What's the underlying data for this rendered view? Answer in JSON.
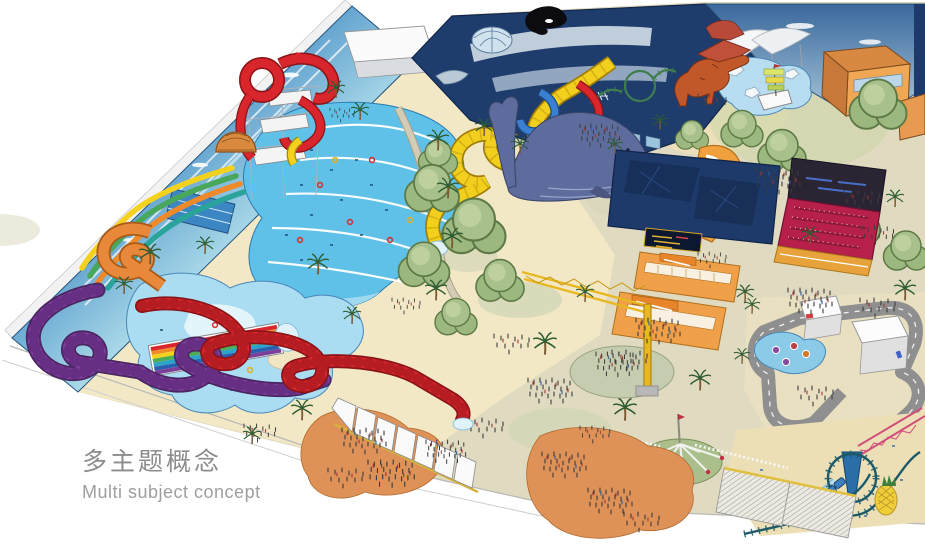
{
  "caption": {
    "title_zh": "多主题概念",
    "subtitle_en": "Multi subject concept",
    "title_color": "#8c8c8c",
    "subtitle_color": "#9e9e9e"
  },
  "illustration": {
    "type": "isometric hand-drawn concept rendering of a multi-themed indoor park",
    "zones": [
      {
        "name": "water-park",
        "features": [
          "ocean-mural-perimeter-wall",
          "wave-pool-with-swimmers",
          "red-slide-tower-complex",
          "yellow-serpentine-slide",
          "blue-tube-slide",
          "red-tube-slide",
          "rainbow-racer-slide",
          "purple-coil-slide",
          "red-coil-slide",
          "orange-spiral-slide",
          "kids-pool",
          "lap-pool",
          "palm-trees",
          "white-roof-box"
        ]
      },
      {
        "name": "aquarium-zone",
        "features": [
          "dark-navy-aquarium-building",
          "orca-mural",
          "glass-dome",
          "fish-murals",
          "whale-statue"
        ]
      },
      {
        "name": "dinosaur-zone",
        "features": [
          "sky-mural-wall",
          "t-rex-statue",
          "roof-dinosaur",
          "rapids-pool-with-ship",
          "ice-rocks",
          "green-mini-coaster",
          "orange-lodge-buildings",
          "white-sail-canopy"
        ]
      },
      {
        "name": "show-zone",
        "features": [
          "navy-show-building",
          "marquee-sign",
          "red-amphitheater-with-screen",
          "orange-retail-stands"
        ]
      },
      {
        "name": "rides-zone",
        "features": [
          "go-kart-track",
          "kart-pit-buildings",
          "bumper-boat-pond",
          "roller-coaster-with-loop",
          "blue-coaster-train",
          "pineapple-sculpture",
          "pink-truss-bridge",
          "star-flyer-ride",
          "yellow-crane-ride"
        ]
      },
      {
        "name": "entrance-promenade",
        "features": [
          "white-canopy-walkway",
          "orange-plazas",
          "crowds",
          "central-tree-cluster",
          "hatched-roofs"
        ]
      }
    ],
    "palette": {
      "wall_blue_deep": "#2a5f9e",
      "wall_blue_light": "#a8d8e8",
      "pool_blue": "#5fc0e8",
      "kids_pool_blue": "#aadcf2",
      "sand": "#f3e8c6",
      "promenade": "#e0dac0",
      "tree_green": "#9cb87f",
      "slide_red": "#d8262c",
      "slide_yellow": "#f2cf1d",
      "slide_purple": "#7d3f9e",
      "slide_orange": "#e8883a",
      "aquarium_navy": "#1e3c6c",
      "theater_red": "#b6204b",
      "retail_orange": "#f0a049",
      "plaza_orange": "#df9257",
      "track_gray": "#8f8f8f",
      "coaster_teal": "#1c5a6a",
      "whale_slate": "#5d6b9d",
      "dino_orange": "#c2582a"
    }
  }
}
